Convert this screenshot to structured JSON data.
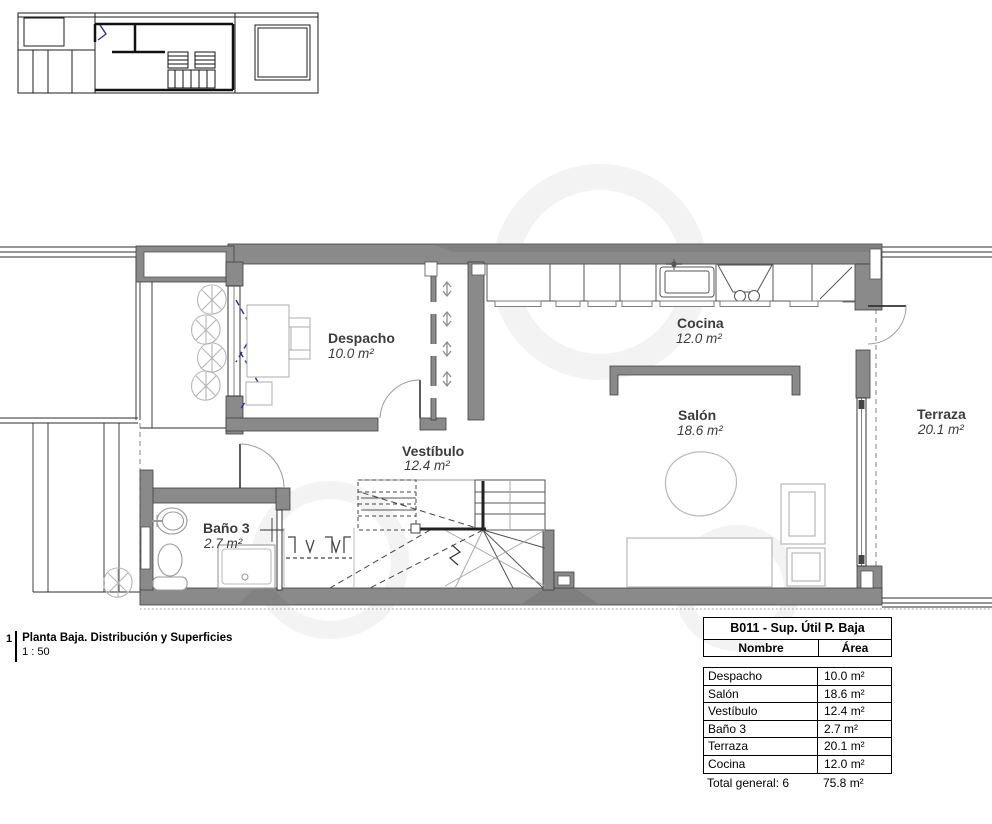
{
  "title_block": {
    "number": "1",
    "title": "Planta Baja. Distribución y Superficies",
    "scale": "1 : 50"
  },
  "rooms": {
    "despacho": {
      "name": "Despacho",
      "area": "10.0 m²"
    },
    "cocina": {
      "name": "Cocina",
      "area": "12.0 m²"
    },
    "salon": {
      "name": "Salón",
      "area": "18.6 m²"
    },
    "vestibulo": {
      "name": "Vestíbulo",
      "area": "12.4 m²"
    },
    "bano3": {
      "name": "Baño 3",
      "area": "2.7 m²"
    },
    "terraza": {
      "name": "Terraza",
      "area": "20.1 m²"
    }
  },
  "area_table": {
    "title": "B011 - Sup. Útil P. Baja",
    "col_name": "Nombre",
    "col_area": "Área",
    "rows": [
      {
        "name": "Despacho",
        "area": "10.0 m²"
      },
      {
        "name": "Salón",
        "area": "18.6 m²"
      },
      {
        "name": "Vestíbulo",
        "area": "12.4 m²"
      },
      {
        "name": "Baño 3",
        "area": "2.7 m²"
      },
      {
        "name": "Terraza",
        "area": "20.1 m²"
      },
      {
        "name": "Cocina",
        "area": "12.0 m²"
      }
    ],
    "total_label": "Total general: 6",
    "total_area": "75.8 m²"
  },
  "colors": {
    "wall_fill": "#8a8a8a",
    "wall_edge": "#3e3e3e",
    "furniture_line": "#b3b3b3",
    "label_text": "#3c3c3c",
    "accent_navy": "#2e3192"
  }
}
